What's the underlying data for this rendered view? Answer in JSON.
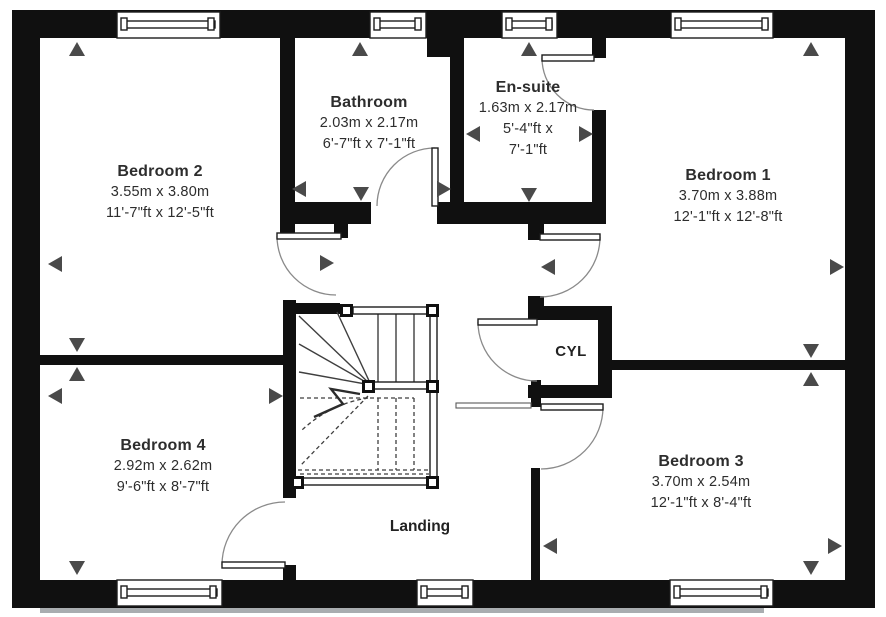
{
  "floor_plan": {
    "rooms": [
      {
        "name": "Bedroom 2",
        "metric": "3.55m x 3.80m",
        "imperial": "11'-7\"ft x 12'-5\"ft"
      },
      {
        "name": "Bathroom",
        "metric": "2.03m x 2.17m",
        "imperial": "6'-7\"ft x 7'-1\"ft"
      },
      {
        "name": "En-suite",
        "metric": "1.63m x 2.17m",
        "imperial_line1": "5'-4\"ft x",
        "imperial_line2": "7'-1\"ft"
      },
      {
        "name": "Bedroom 1",
        "metric": "3.70m x 3.88m",
        "imperial": "12'-1\"ft x 12'-8\"ft"
      },
      {
        "name": "Bedroom 4",
        "metric": "2.92m x 2.62m",
        "imperial": "9'-6\"ft x 8'-7\"ft"
      },
      {
        "name": "Bedroom 3",
        "metric": "3.70m x 2.54m",
        "imperial": "12'-1\"ft x 8'-4\"ft"
      }
    ],
    "labels": {
      "cylinder_cupboard": "CYL",
      "landing": "Landing"
    },
    "colors": {
      "wall": "#101010",
      "line": "#3f3f3f",
      "arrow": "#4a4a4a",
      "text": "#2d2d2d"
    }
  }
}
